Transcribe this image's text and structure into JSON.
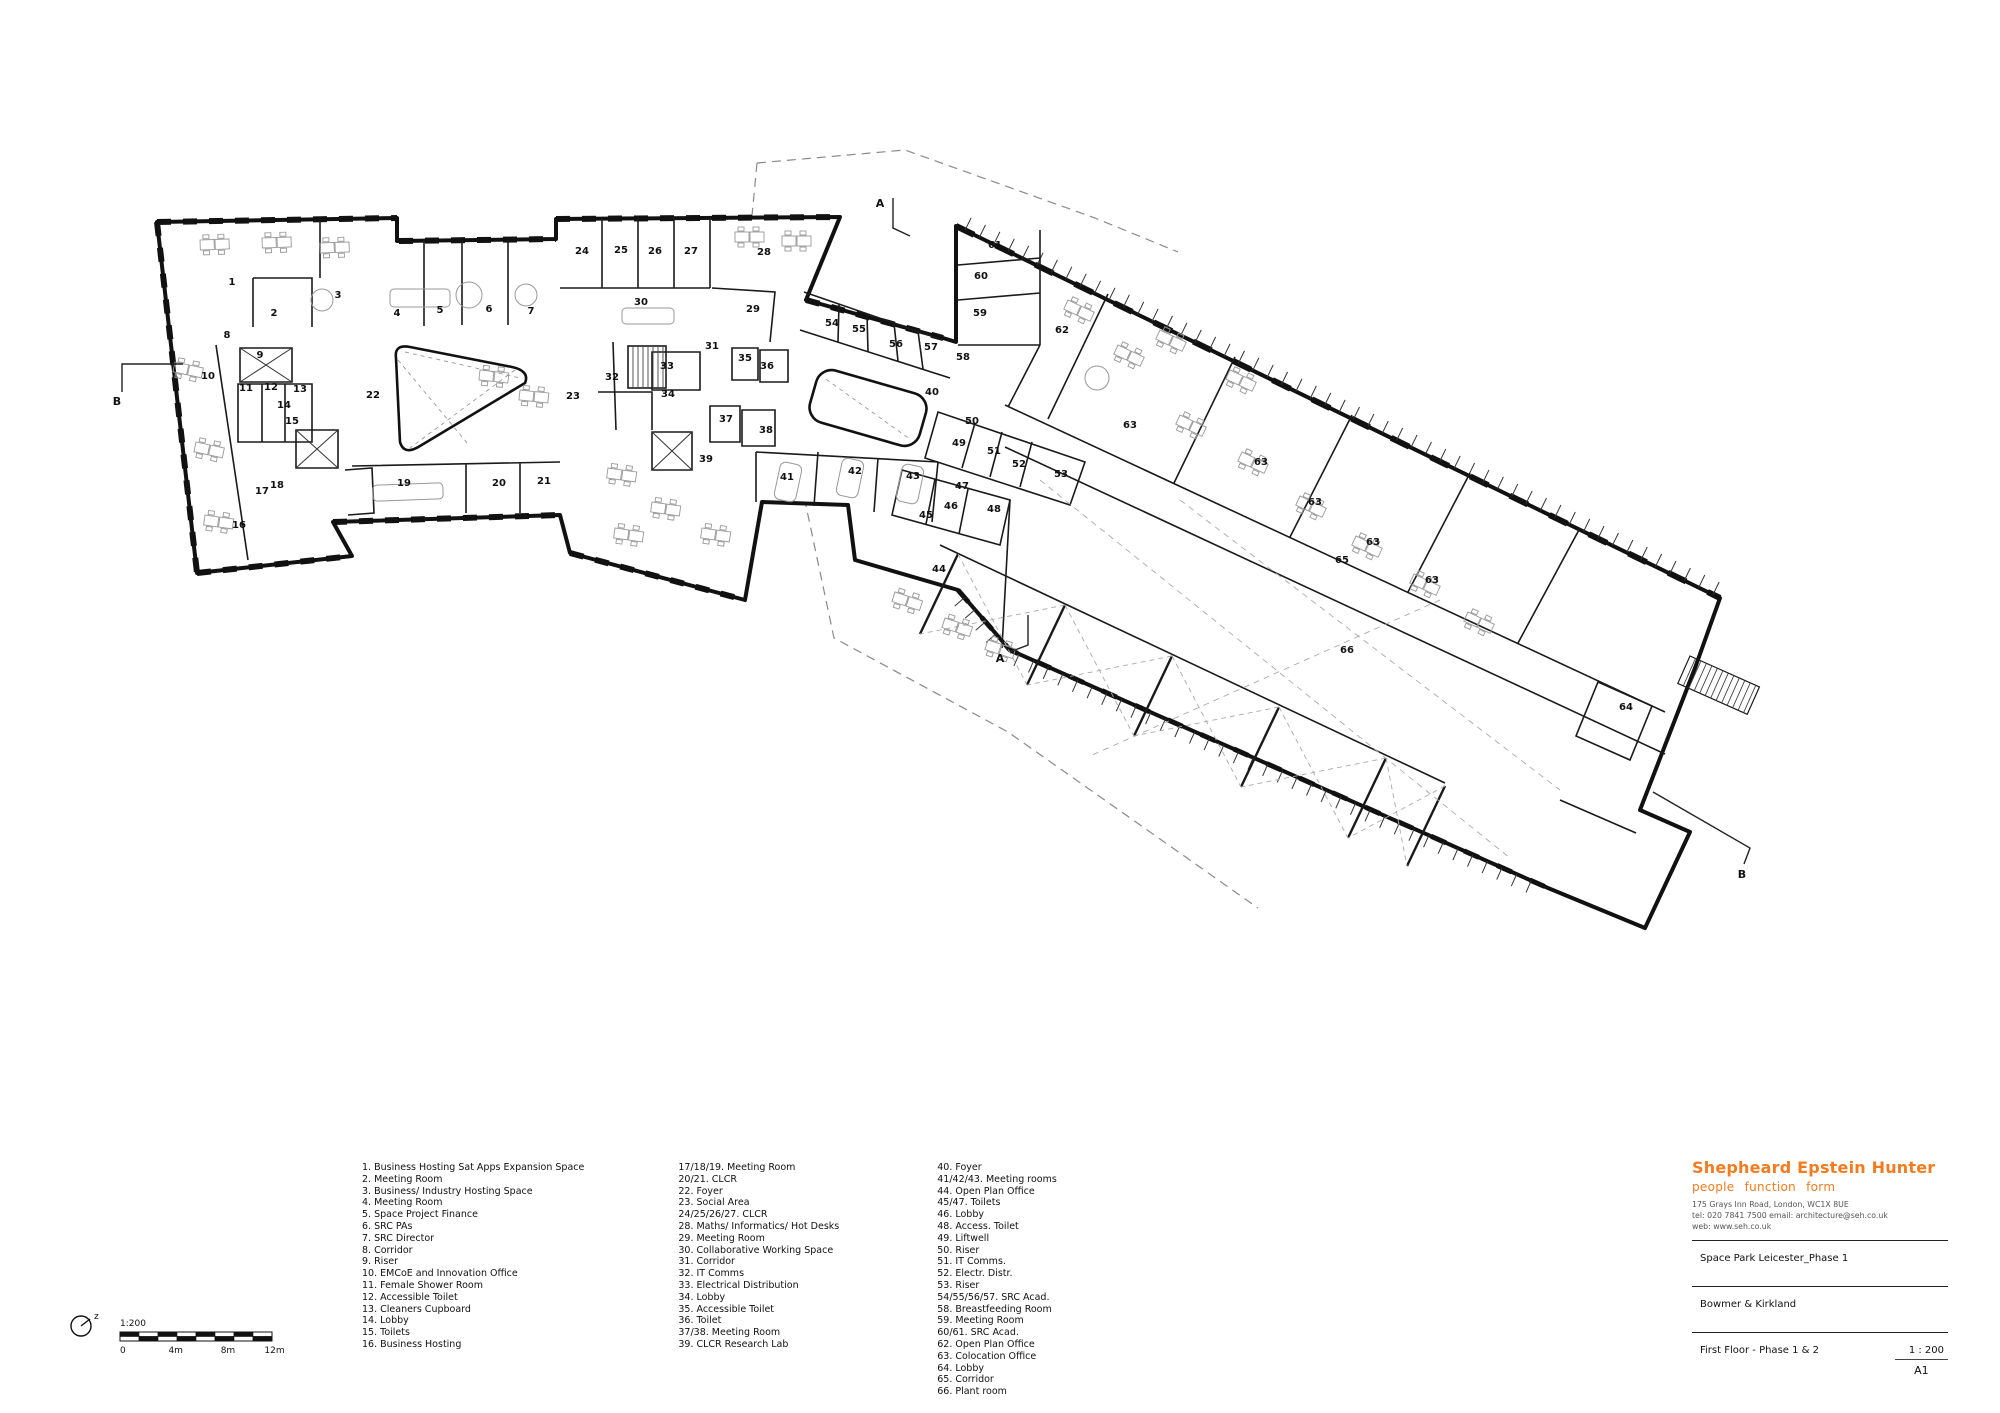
{
  "plan": {
    "room_labels": [
      {
        "t": "1",
        "x": 232,
        "y": 285
      },
      {
        "t": "2",
        "x": 274,
        "y": 316
      },
      {
        "t": "3",
        "x": 338,
        "y": 298
      },
      {
        "t": "4",
        "x": 397,
        "y": 316
      },
      {
        "t": "5",
        "x": 440,
        "y": 313
      },
      {
        "t": "6",
        "x": 489,
        "y": 312
      },
      {
        "t": "7",
        "x": 531,
        "y": 314
      },
      {
        "t": "8",
        "x": 227,
        "y": 338
      },
      {
        "t": "9",
        "x": 260,
        "y": 358
      },
      {
        "t": "10",
        "x": 208,
        "y": 379
      },
      {
        "t": "11",
        "x": 246,
        "y": 391
      },
      {
        "t": "12",
        "x": 271,
        "y": 390
      },
      {
        "t": "13",
        "x": 300,
        "y": 392
      },
      {
        "t": "14",
        "x": 284,
        "y": 408
      },
      {
        "t": "15",
        "x": 292,
        "y": 424
      },
      {
        "t": "16",
        "x": 239,
        "y": 528
      },
      {
        "t": "17",
        "x": 262,
        "y": 494
      },
      {
        "t": "18",
        "x": 277,
        "y": 488
      },
      {
        "t": "19",
        "x": 404,
        "y": 486
      },
      {
        "t": "20",
        "x": 499,
        "y": 486
      },
      {
        "t": "21",
        "x": 544,
        "y": 484
      },
      {
        "t": "22",
        "x": 373,
        "y": 398
      },
      {
        "t": "23",
        "x": 573,
        "y": 399
      },
      {
        "t": "24",
        "x": 582,
        "y": 254
      },
      {
        "t": "25",
        "x": 621,
        "y": 253
      },
      {
        "t": "26",
        "x": 655,
        "y": 254
      },
      {
        "t": "27",
        "x": 691,
        "y": 254
      },
      {
        "t": "28",
        "x": 764,
        "y": 255
      },
      {
        "t": "29",
        "x": 753,
        "y": 312
      },
      {
        "t": "30",
        "x": 641,
        "y": 305
      },
      {
        "t": "31",
        "x": 712,
        "y": 349
      },
      {
        "t": "32",
        "x": 612,
        "y": 380
      },
      {
        "t": "33",
        "x": 667,
        "y": 369
      },
      {
        "t": "34",
        "x": 668,
        "y": 397
      },
      {
        "t": "35",
        "x": 745,
        "y": 361
      },
      {
        "t": "36",
        "x": 767,
        "y": 369
      },
      {
        "t": "37",
        "x": 726,
        "y": 422
      },
      {
        "t": "38",
        "x": 766,
        "y": 433
      },
      {
        "t": "39",
        "x": 706,
        "y": 462
      },
      {
        "t": "40",
        "x": 932,
        "y": 395
      },
      {
        "t": "41",
        "x": 787,
        "y": 480
      },
      {
        "t": "42",
        "x": 855,
        "y": 474
      },
      {
        "t": "43",
        "x": 913,
        "y": 479
      },
      {
        "t": "44",
        "x": 939,
        "y": 572
      },
      {
        "t": "45",
        "x": 926,
        "y": 518
      },
      {
        "t": "46",
        "x": 951,
        "y": 509
      },
      {
        "t": "47",
        "x": 962,
        "y": 489
      },
      {
        "t": "48",
        "x": 994,
        "y": 512
      },
      {
        "t": "49",
        "x": 959,
        "y": 446
      },
      {
        "t": "50",
        "x": 972,
        "y": 424
      },
      {
        "t": "51",
        "x": 994,
        "y": 454
      },
      {
        "t": "52",
        "x": 1019,
        "y": 467
      },
      {
        "t": "53",
        "x": 1061,
        "y": 477
      },
      {
        "t": "54",
        "x": 832,
        "y": 326
      },
      {
        "t": "55",
        "x": 859,
        "y": 332
      },
      {
        "t": "56",
        "x": 896,
        "y": 347
      },
      {
        "t": "57",
        "x": 931,
        "y": 350
      },
      {
        "t": "58",
        "x": 963,
        "y": 360
      },
      {
        "t": "59",
        "x": 980,
        "y": 316
      },
      {
        "t": "60",
        "x": 981,
        "y": 279
      },
      {
        "t": "61",
        "x": 995,
        "y": 248
      },
      {
        "t": "62",
        "x": 1062,
        "y": 333
      },
      {
        "t": "63",
        "x": 1130,
        "y": 428
      },
      {
        "t": "63",
        "x": 1261,
        "y": 465
      },
      {
        "t": "63",
        "x": 1315,
        "y": 505
      },
      {
        "t": "63",
        "x": 1373,
        "y": 545
      },
      {
        "t": "63",
        "x": 1432,
        "y": 583
      },
      {
        "t": "64",
        "x": 1626,
        "y": 710
      },
      {
        "t": "65",
        "x": 1342,
        "y": 563
      },
      {
        "t": "66",
        "x": 1347,
        "y": 653
      }
    ],
    "section_markers": [
      {
        "t": "A",
        "x": 880,
        "y": 207
      },
      {
        "t": "A",
        "x": 1000,
        "y": 662
      },
      {
        "t": "B",
        "x": 117,
        "y": 405
      },
      {
        "t": "B",
        "x": 1742,
        "y": 878
      }
    ],
    "north_label": "z"
  },
  "scalebar": {
    "ratio": "1:200",
    "ticks": [
      "0",
      "4m",
      "8m",
      "12m"
    ]
  },
  "legend": {
    "col1": [
      "1. Business Hosting Sat Apps Expansion Space",
      "2. Meeting Room",
      "3. Business/ Industry Hosting Space",
      "4. Meeting Room",
      "5. Space Project Finance",
      "6. SRC PAs",
      "7. SRC Director",
      "8. Corridor",
      "9. Riser",
      "10. EMCoE and Innovation Office",
      "11. Female Shower Room",
      "12. Accessible Toilet",
      "13. Cleaners Cupboard",
      "14. Lobby",
      "15. Toilets",
      "16. Business Hosting"
    ],
    "col2": [
      "17/18/19. Meeting Room",
      "20/21. CLCR",
      "22. Foyer",
      "23. Social Area",
      "24/25/26/27. CLCR",
      "28. Maths/ Informatics/ Hot Desks",
      "29. Meeting Room",
      "30. Collaborative Working Space",
      "31. Corridor",
      "32. IT Comms",
      "33. Electrical Distribution",
      "34. Lobby",
      "35. Accessible Toilet",
      "36. Toilet",
      "37/38. Meeting Room",
      "39. CLCR Research Lab"
    ],
    "col3": [
      "40. Foyer",
      "41/42/43. Meeting rooms",
      "44. Open Plan Office",
      "45/47. Toilets",
      "46. Lobby",
      "48. Access. Toilet",
      "49. Liftwell",
      "50. Riser",
      "51. IT Comms.",
      "52. Electr. Distr.",
      "53. Riser",
      "54/55/56/57. SRC Acad.",
      "58. Breastfeeding Room",
      "59. Meeting Room",
      "60/61. SRC Acad.",
      "62. Open Plan Office",
      "63. Colocation Office",
      "64. Lobby",
      "65. Corridor",
      "66. Plant room"
    ]
  },
  "titleblock": {
    "brand": "Shepheard Epstein Hunter",
    "tagline": "people  function  form",
    "address": "175 Grays Inn Road, London, WC1X 8UE",
    "contact": "tel: 020 7841 7500   email: architecture@seh.co.uk",
    "web": "web: www.seh.co.uk",
    "project": "Space Park Leicester_Phase 1",
    "client": "Bowmer & Kirkland",
    "drawing": "First Floor - Phase 1 & 2",
    "scale": "1 : 200",
    "paper": "A1"
  }
}
